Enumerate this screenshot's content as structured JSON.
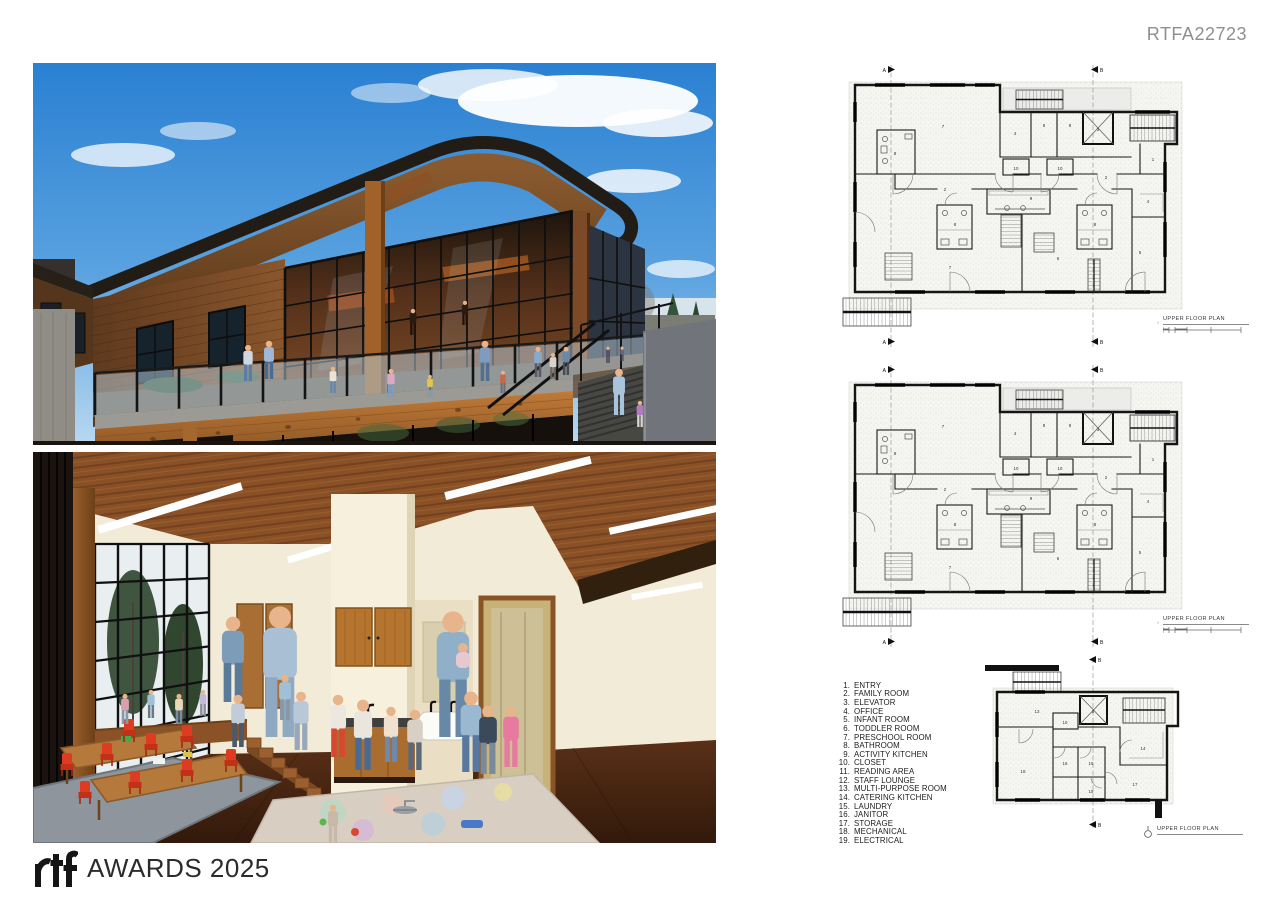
{
  "header": {
    "code": "RTFA22723"
  },
  "plans": [
    {
      "label": "UPPER FLOOR PLAN",
      "section_markers": [
        "A",
        "B"
      ],
      "rooms": [
        {
          "n": "7",
          "x": 108,
          "y": 66
        },
        {
          "n": "8",
          "x": 60,
          "y": 93
        },
        {
          "n": "4",
          "x": 180,
          "y": 73
        },
        {
          "n": "8",
          "x": 209,
          "y": 65
        },
        {
          "n": "8",
          "x": 235,
          "y": 65
        },
        {
          "n": "3",
          "x": 263,
          "y": 69
        },
        {
          "n": "1",
          "x": 318,
          "y": 99
        },
        {
          "n": "10",
          "x": 181,
          "y": 108
        },
        {
          "n": "10",
          "x": 225,
          "y": 108
        },
        {
          "n": "2",
          "x": 271,
          "y": 117
        },
        {
          "n": "2",
          "x": 110,
          "y": 129
        },
        {
          "n": "9",
          "x": 196,
          "y": 138
        },
        {
          "n": "8",
          "x": 120,
          "y": 164
        },
        {
          "n": "8",
          "x": 260,
          "y": 164
        },
        {
          "n": "4",
          "x": 313,
          "y": 141
        },
        {
          "n": "7",
          "x": 115,
          "y": 207
        },
        {
          "n": "6",
          "x": 223,
          "y": 198
        },
        {
          "n": "5",
          "x": 305,
          "y": 192
        }
      ]
    },
    {
      "label": "UPPER FLOOR PLAN",
      "section_markers": [
        "A",
        "B"
      ],
      "rooms": [
        {
          "n": "7",
          "x": 108,
          "y": 66
        },
        {
          "n": "8",
          "x": 60,
          "y": 93
        },
        {
          "n": "4",
          "x": 180,
          "y": 73
        },
        {
          "n": "8",
          "x": 209,
          "y": 65
        },
        {
          "n": "8",
          "x": 235,
          "y": 65
        },
        {
          "n": "3",
          "x": 263,
          "y": 69
        },
        {
          "n": "1",
          "x": 318,
          "y": 99
        },
        {
          "n": "10",
          "x": 181,
          "y": 108
        },
        {
          "n": "10",
          "x": 225,
          "y": 108
        },
        {
          "n": "2",
          "x": 271,
          "y": 117
        },
        {
          "n": "2",
          "x": 110,
          "y": 129
        },
        {
          "n": "9",
          "x": 196,
          "y": 138
        },
        {
          "n": "8",
          "x": 120,
          "y": 164
        },
        {
          "n": "8",
          "x": 260,
          "y": 164
        },
        {
          "n": "4",
          "x": 313,
          "y": 141
        },
        {
          "n": "7",
          "x": 115,
          "y": 207
        },
        {
          "n": "6",
          "x": 223,
          "y": 198
        },
        {
          "n": "5",
          "x": 305,
          "y": 192
        }
      ]
    },
    {
      "label": "UPPER FLOOR PLAN",
      "section_markers": [
        "B"
      ],
      "rooms": [
        {
          "n": "13",
          "x": 52,
          "y": 61
        },
        {
          "n": "3",
          "x": 108,
          "y": 61
        },
        {
          "n": "10",
          "x": 80,
          "y": 72
        },
        {
          "n": "14",
          "x": 158,
          "y": 98
        },
        {
          "n": "16",
          "x": 80,
          "y": 113
        },
        {
          "n": "15",
          "x": 106,
          "y": 113
        },
        {
          "n": "18",
          "x": 38,
          "y": 121
        },
        {
          "n": "19",
          "x": 106,
          "y": 141
        },
        {
          "n": "17",
          "x": 150,
          "y": 134
        }
      ]
    }
  ],
  "legend": {
    "items": [
      {
        "num": "1.",
        "label": "ENTRY"
      },
      {
        "num": "2.",
        "label": "FAMILY ROOM"
      },
      {
        "num": "3.",
        "label": "ELEVATOR"
      },
      {
        "num": "4.",
        "label": "OFFICE"
      },
      {
        "num": "5.",
        "label": "INFANT ROOM"
      },
      {
        "num": "6.",
        "label": "TODDLER ROOM"
      },
      {
        "num": "7.",
        "label": "PRESCHOOL ROOM"
      },
      {
        "num": "8.",
        "label": "BATHROOM"
      },
      {
        "num": "9.",
        "label": "ACTIVITY KITCHEN"
      },
      {
        "num": "10.",
        "label": "CLOSET"
      },
      {
        "num": "11.",
        "label": "READING AREA"
      },
      {
        "num": "12.",
        "label": "STAFF LOUNGE"
      },
      {
        "num": "13.",
        "label": "MULTI-PURPOSE ROOM"
      },
      {
        "num": "14.",
        "label": "CATERING KITCHEN"
      },
      {
        "num": "15.",
        "label": "LAUNDRY"
      },
      {
        "num": "16.",
        "label": "JANITOR"
      },
      {
        "num": "17.",
        "label": "STORAGE"
      },
      {
        "num": "18.",
        "label": "MECHANICAL"
      },
      {
        "num": "19.",
        "label": "ELECTRICAL"
      }
    ]
  },
  "footer": {
    "brand": "rtf",
    "awards": "AWARDS 2025"
  }
}
